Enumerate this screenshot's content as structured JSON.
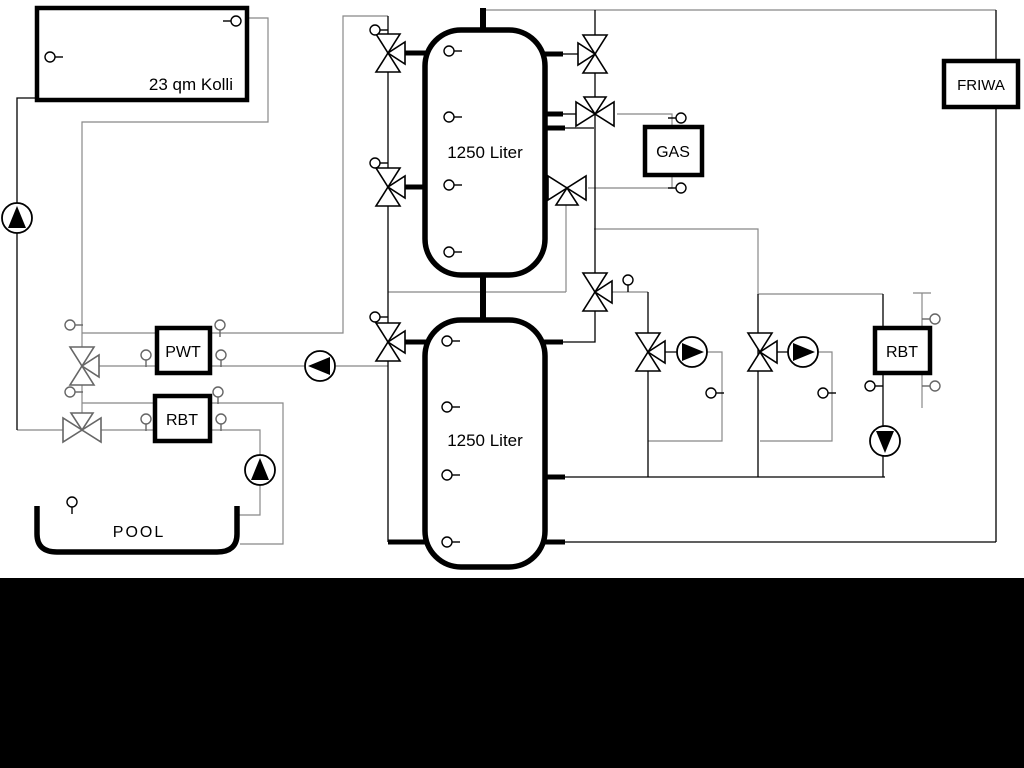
{
  "diagram": {
    "title_hint": "heating-system-schematic",
    "collector": {
      "label": "23 qm Kolli"
    },
    "tank_upper": {
      "label": "1250 Liter"
    },
    "tank_lower": {
      "label": "1250 Liter"
    },
    "gas": {
      "label": "GAS"
    },
    "friwa": {
      "label": "FRIWA"
    },
    "pwt": {
      "label": "PWT"
    },
    "rbt_left": {
      "label": "RBT"
    },
    "rbt_right": {
      "label": "RBT"
    },
    "pool": {
      "label": "POOL"
    },
    "colors": {
      "pipe_black": "#000000",
      "pipe_gray": "#888888",
      "background": "#ffffff",
      "footer_band": "#000000"
    }
  }
}
